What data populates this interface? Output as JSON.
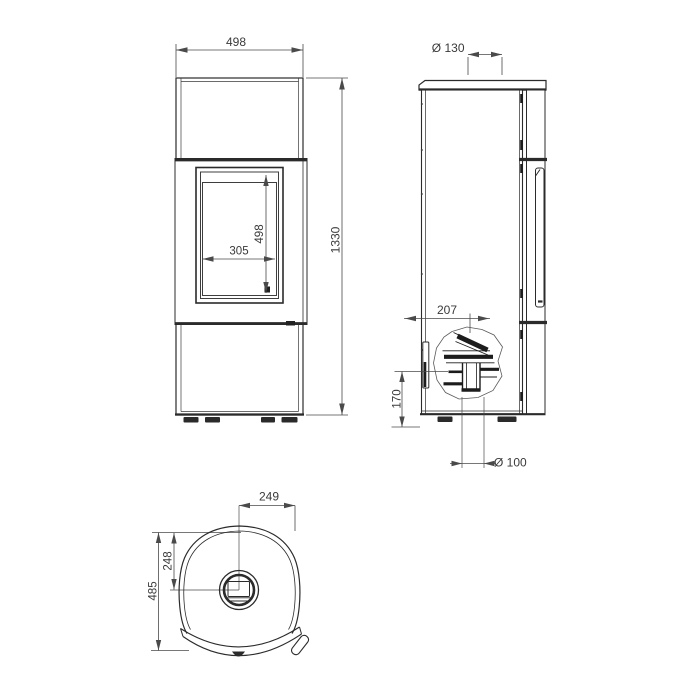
{
  "colors": {
    "background": "#ffffff",
    "line": "#2b2b2b",
    "dim_line": "#4a4a4a",
    "text": "#3a3a3a",
    "dark_fill": "#1f1f1f"
  },
  "front_view": {
    "overall_width_mm": "498",
    "overall_height_mm": "1330",
    "glass_width_mm": "305",
    "glass_height_mm": "498"
  },
  "side_view": {
    "flue_collar_diameter": "Ø 130",
    "rear_outlet_offset_mm": "207",
    "rear_outlet_height_mm": "170",
    "floor_outlet_diameter": "Ø 100"
  },
  "top_view": {
    "flue_center_to_side_mm": "249",
    "back_to_flue_center_mm": "248",
    "overall_depth_mm": "485"
  }
}
